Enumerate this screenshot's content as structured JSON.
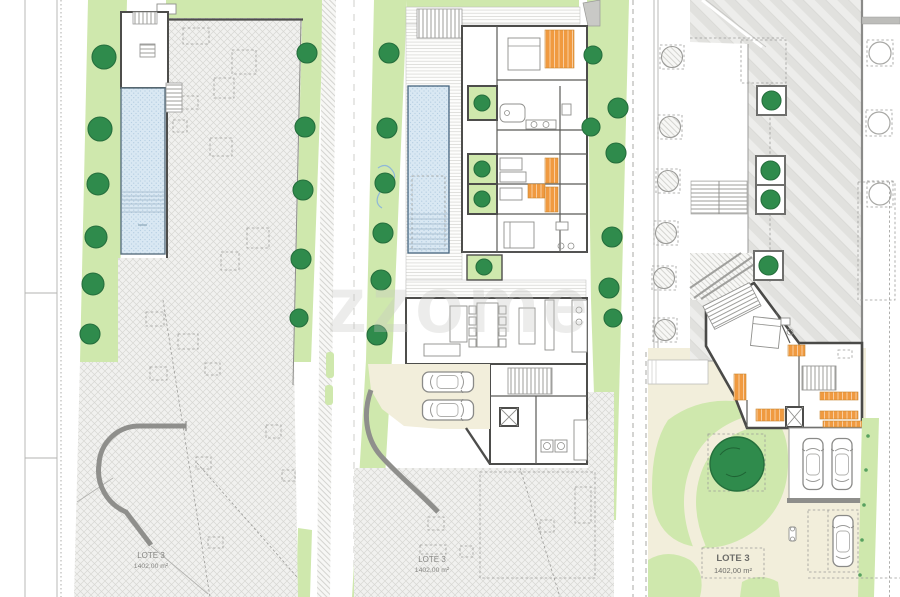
{
  "sheet": {
    "watermark": "zzome"
  },
  "panels": {
    "left": {
      "lot_label": "LOTE 3",
      "lot_area": "1402,00 m²"
    },
    "middle": {
      "lot_label": "LOTE 3",
      "lot_area": "1402,00 m²"
    },
    "right": {
      "lot_label": "LOTE 3",
      "lot_area": "1402,00 m²"
    }
  },
  "colors": {
    "paper": "#ffffff",
    "lawn_green": "#cfe8ad",
    "tree_green": "#2f8b4c",
    "pool_blue": "#d9e8f3",
    "cream": "#f2eedb",
    "wardrobe_orange": "#f09a40",
    "wall_gray": "#4d4d4b",
    "hatch_gray": "#d7d7d3"
  }
}
